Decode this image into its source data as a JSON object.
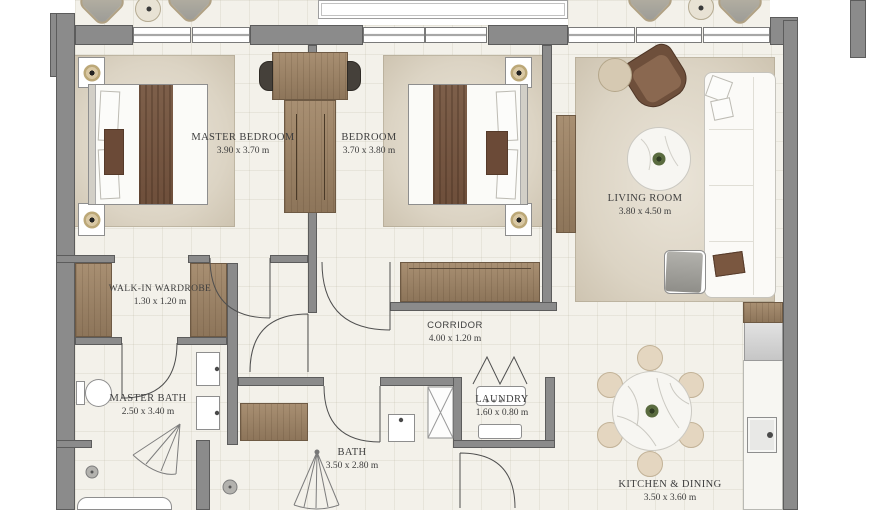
{
  "plan": {
    "units": "m",
    "rooms": [
      {
        "name": "MASTER BEDROOM",
        "dims": "3.90 x 3.70 m"
      },
      {
        "name": "BEDROOM",
        "dims": "3.70 x 3.80 m"
      },
      {
        "name": "LIVING ROOM",
        "dims": "3.80 x 4.50 m"
      },
      {
        "name": "WALK-IN WARDROBE",
        "dims": "1.30 x 1.20 m"
      },
      {
        "name": "CORRIDOR",
        "dims": "4.00 x 1.20 m"
      },
      {
        "name": "MASTER BATH",
        "dims": "2.50 x 3.40 m"
      },
      {
        "name": "LAUNDRY",
        "dims": "1.60 x 0.80 m"
      },
      {
        "name": "BATH",
        "dims": "3.50 x 2.80 m"
      },
      {
        "name": "KITCHEN & DINING",
        "dims": "3.50 x 3.60 m"
      }
    ],
    "fixtures": [
      "double-bed",
      "nightstand-lamp",
      "wardrobe-closet",
      "desk-with-chairs",
      "sofa",
      "armchair",
      "coffee-table",
      "dining-table-six-chairs",
      "kitchen-counter-sink",
      "fridge",
      "washing-machine",
      "toilet",
      "twin-sinks",
      "bathtub",
      "shower",
      "balcony-lounge-chairs",
      "tv-console"
    ],
    "colors": {
      "wall": "#8b8b8b",
      "wall_edge": "#5c5c5c",
      "floor": "#f3f1ea",
      "rug": "#dcd4c4",
      "wood": "#9c8569",
      "accent_brown": "#6e4f3b",
      "text": "#3e3e3e"
    }
  }
}
